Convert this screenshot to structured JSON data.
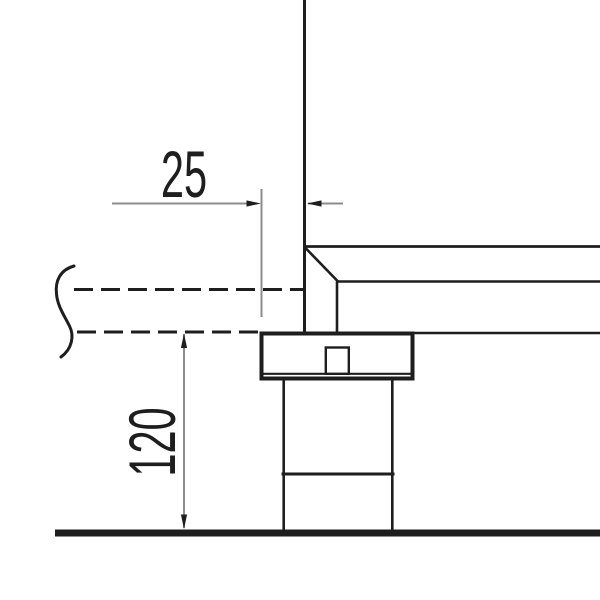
{
  "drawing": {
    "kind": "technical-section-detail",
    "dimensions": {
      "offset": {
        "label": "25",
        "orientation": "horizontal"
      },
      "height": {
        "label": "120",
        "orientation": "vertical"
      }
    },
    "colors": {
      "object_line": "#1e1e1e",
      "dimension_line": "#8d8d8d",
      "background": "#ffffff"
    }
  }
}
